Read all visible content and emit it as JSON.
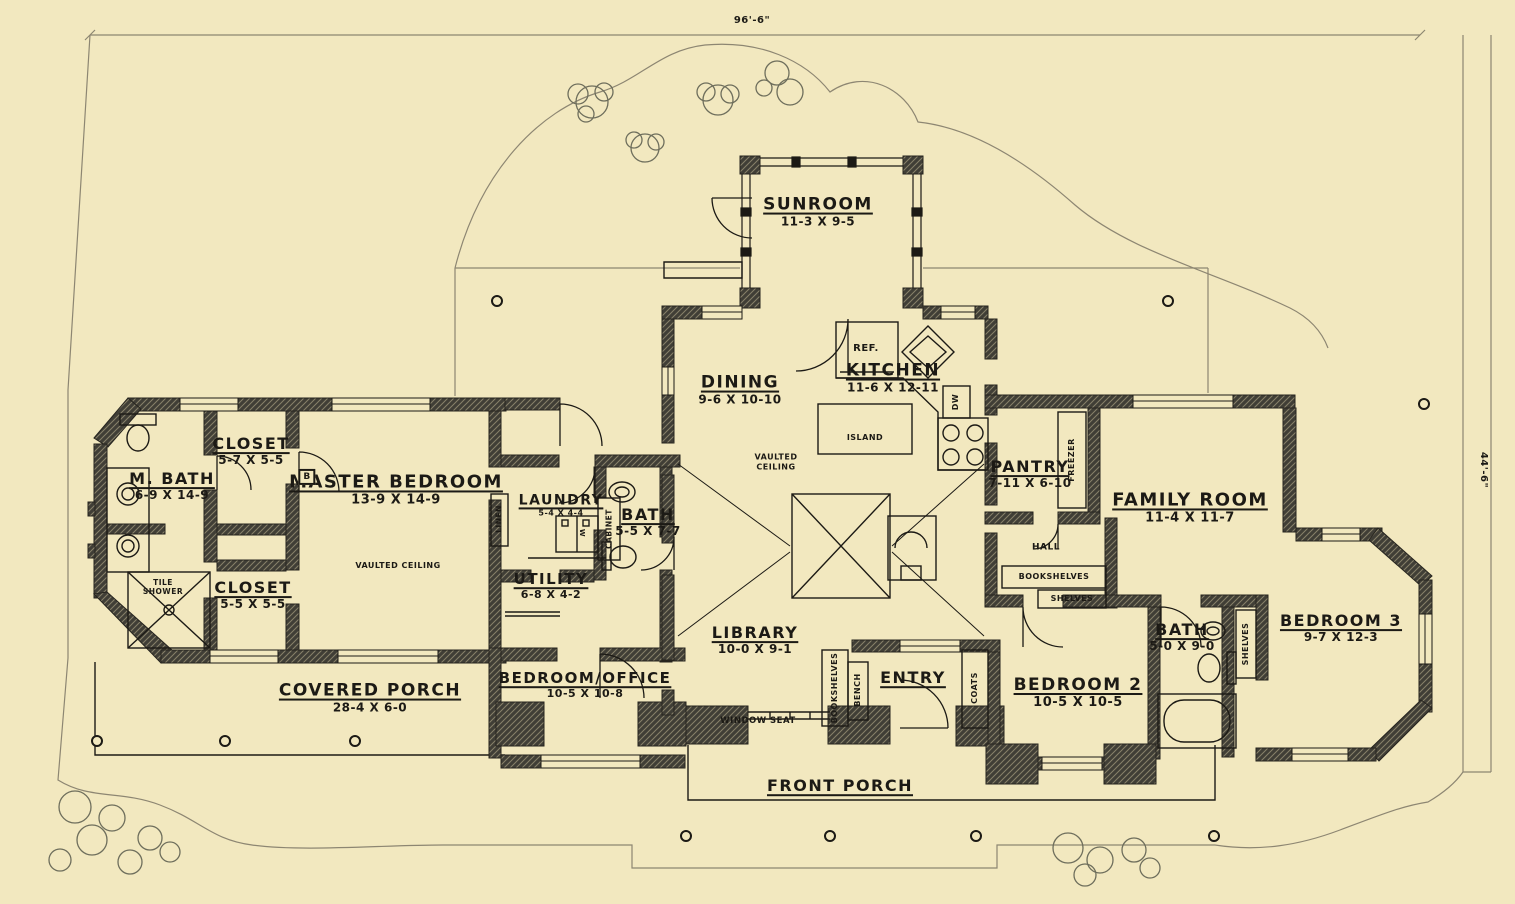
{
  "meta": {
    "title": "House Floor Plan",
    "background_color": "#f2e8bf",
    "wall_color": "#403e36",
    "wall_hatch_color": "#cfc49c",
    "line_color": "#1c1a15",
    "site_line_color": "#8d8672",
    "tree_color": "#6e6e5c"
  },
  "dimensions": {
    "overall_width": "96'-6\"",
    "overall_depth": "44'-6\""
  },
  "rooms": [
    {
      "id": "sunroom",
      "name": "SUNROOM",
      "dim": "11-3 X 9-5",
      "x": 818,
      "y": 212,
      "ns": 17,
      "ds": 12
    },
    {
      "id": "dining",
      "name": "DINING",
      "dim": "9-6 X 10-10",
      "x": 740,
      "y": 390,
      "ns": 17,
      "ds": 12
    },
    {
      "id": "kitchen",
      "name": "KITCHEN",
      "dim": "11-6 X 12-11",
      "x": 893,
      "y": 378,
      "ns": 17,
      "ds": 12
    },
    {
      "id": "pantry",
      "name": "PANTRY",
      "dim": "7-11 X 6-10",
      "x": 1030,
      "y": 474,
      "ns": 16,
      "ds": 12
    },
    {
      "id": "family-room",
      "name": "FAMILY ROOM",
      "dim": "11-4 X 11-7",
      "x": 1190,
      "y": 508,
      "ns": 18,
      "ds": 13
    },
    {
      "id": "m-bath",
      "name": "M. BATH",
      "dim": "6-9 X 14-9",
      "x": 172,
      "y": 486,
      "ns": 16,
      "ds": 12
    },
    {
      "id": "closet-1",
      "name": "CLOSET",
      "dim": "5-7 X 5-5",
      "x": 251,
      "y": 451,
      "ns": 16,
      "ds": 12
    },
    {
      "id": "master-bedroom",
      "name": "MASTER BEDROOM",
      "dim": "13-9 X 14-9",
      "x": 396,
      "y": 490,
      "ns": 18,
      "ds": 13
    },
    {
      "id": "closet-2",
      "name": "CLOSET",
      "dim": "5-5 X 5-5",
      "x": 253,
      "y": 595,
      "ns": 16,
      "ds": 12
    },
    {
      "id": "laundry",
      "name": "LAUNDRY",
      "dim": "5-4 X 4-4",
      "x": 561,
      "y": 506,
      "ns": 14,
      "ds": 8
    },
    {
      "id": "bath-1",
      "name": "BATH",
      "dim": "5-5 X 7-7",
      "x": 648,
      "y": 522,
      "ns": 16,
      "ds": 12
    },
    {
      "id": "utility",
      "name": "UTILITY",
      "dim": "6-8 X 4-2",
      "x": 551,
      "y": 586,
      "ns": 15,
      "ds": 11
    },
    {
      "id": "library",
      "name": "LIBRARY",
      "dim": "10-0 X 9-1",
      "x": 755,
      "y": 640,
      "ns": 16,
      "ds": 12
    },
    {
      "id": "entry",
      "name": "ENTRY",
      "dim": "",
      "x": 913,
      "y": 678,
      "ns": 16,
      "ds": 11
    },
    {
      "id": "bedroom-office",
      "name": "BEDROOM/OFFICE",
      "dim": "10-5 X 10-8",
      "x": 585,
      "y": 685,
      "ns": 15,
      "ds": 11
    },
    {
      "id": "covered-porch",
      "name": "COVERED PORCH",
      "dim": "28-4 X 6-0",
      "x": 370,
      "y": 698,
      "ns": 17,
      "ds": 12
    },
    {
      "id": "front-porch",
      "name": "FRONT PORCH",
      "dim": "",
      "x": 840,
      "y": 786,
      "ns": 16,
      "ds": 11
    },
    {
      "id": "bedroom-2",
      "name": "BEDROOM 2",
      "dim": "10-5 X 10-5",
      "x": 1078,
      "y": 693,
      "ns": 17,
      "ds": 13
    },
    {
      "id": "bath-2",
      "name": "BATH",
      "dim": "5-0 X 9-0",
      "x": 1182,
      "y": 637,
      "ns": 16,
      "ds": 12
    },
    {
      "id": "bedroom-3",
      "name": "BEDROOM 3",
      "dim": "9-7 X 12-3",
      "x": 1341,
      "y": 628,
      "ns": 16,
      "ds": 12
    }
  ],
  "annotations": [
    {
      "id": "ref",
      "text": "REF.",
      "x": 866,
      "y": 349,
      "size": 10
    },
    {
      "id": "island",
      "text": "ISLAND",
      "x": 865,
      "y": 438,
      "size": 8
    },
    {
      "id": "dw",
      "text": "DW",
      "x": 956,
      "y": 402,
      "size": 8,
      "rot": -90
    },
    {
      "id": "vaulted-ceiling-dining",
      "text": "VAULTED\nCEILING",
      "x": 776,
      "y": 462,
      "size": 8
    },
    {
      "id": "vaulted-ceiling-master",
      "text": "VAULTED CEILING",
      "x": 398,
      "y": 566,
      "size": 8
    },
    {
      "id": "tile-shower",
      "text": "TILE\nSHOWER",
      "x": 163,
      "y": 587,
      "size": 7.5
    },
    {
      "id": "linen",
      "text": "LINEN",
      "x": 499,
      "y": 519,
      "size": 7.5,
      "rot": -90
    },
    {
      "id": "cabinet",
      "text": "CABINET",
      "x": 609,
      "y": 529,
      "size": 7.5,
      "rot": -90
    },
    {
      "id": "washer",
      "text": "W",
      "x": 582,
      "y": 533,
      "size": 7,
      "rot": 90
    },
    {
      "id": "freezer",
      "text": "FREEZER",
      "x": 1072,
      "y": 460,
      "size": 8,
      "rot": -90
    },
    {
      "id": "hall",
      "text": "HALL",
      "x": 1046,
      "y": 548,
      "size": 9
    },
    {
      "id": "bookshelves-hall",
      "text": "BOOKSHELVES",
      "x": 1054,
      "y": 577,
      "size": 8
    },
    {
      "id": "shelves-hall",
      "text": "SHELVES",
      "x": 1072,
      "y": 599,
      "size": 8
    },
    {
      "id": "bookshelves-library",
      "text": "BOOKSHELVES",
      "x": 835,
      "y": 688,
      "size": 8,
      "rot": -90
    },
    {
      "id": "bench",
      "text": "BENCH",
      "x": 858,
      "y": 690,
      "size": 8,
      "rot": -90
    },
    {
      "id": "coats",
      "text": "COATS",
      "x": 975,
      "y": 688,
      "size": 8,
      "rot": -90
    },
    {
      "id": "shelves-bath2",
      "text": "SHELVES",
      "x": 1246,
      "y": 644,
      "size": 8,
      "rot": -90
    },
    {
      "id": "window-seat",
      "text": "WINDOW SEAT",
      "x": 758,
      "y": 721,
      "size": 8.5
    },
    {
      "id": "door-tag-b",
      "text": "B",
      "x": 307,
      "y": 477,
      "size": 9,
      "box": true
    },
    {
      "id": "top-dimension",
      "text": "96'-6\"",
      "x": 752,
      "y": 21,
      "size": 10
    },
    {
      "id": "right-dimension",
      "text": "44'-6\"",
      "x": 1483,
      "y": 470,
      "size": 10,
      "rot": 90
    }
  ]
}
